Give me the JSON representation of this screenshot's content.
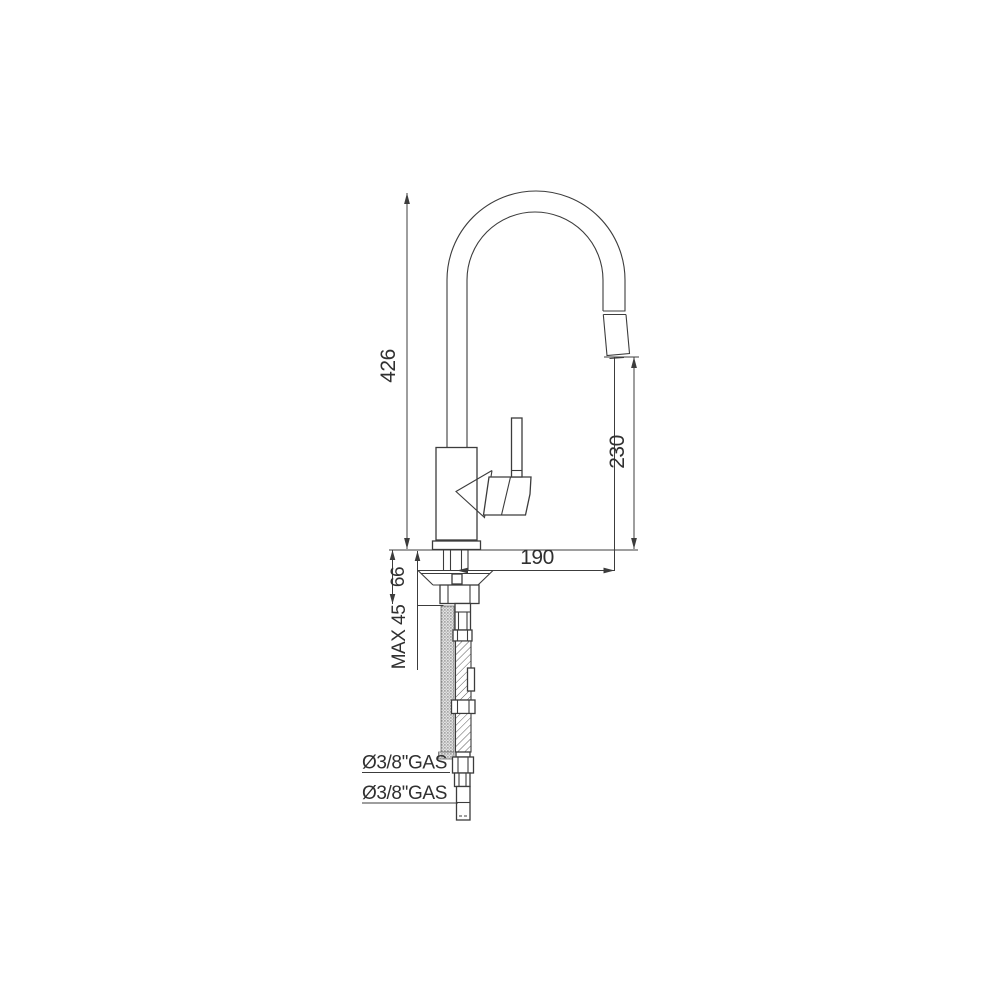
{
  "page": {
    "background": "#ffffff"
  },
  "drawing": {
    "kind": "kitchen-faucet-technical-drawing",
    "line_color": "#3c3c3c",
    "labels": {
      "total_height": "426",
      "spout_outlet_height": "230",
      "spout_reach": "190",
      "under_deck_height": "66",
      "max_counter_thickness": "MAX 45",
      "inlet_connection_top": "Ø3/8''GAS",
      "inlet_connection_bottom": "Ø3/8''GAS"
    }
  }
}
